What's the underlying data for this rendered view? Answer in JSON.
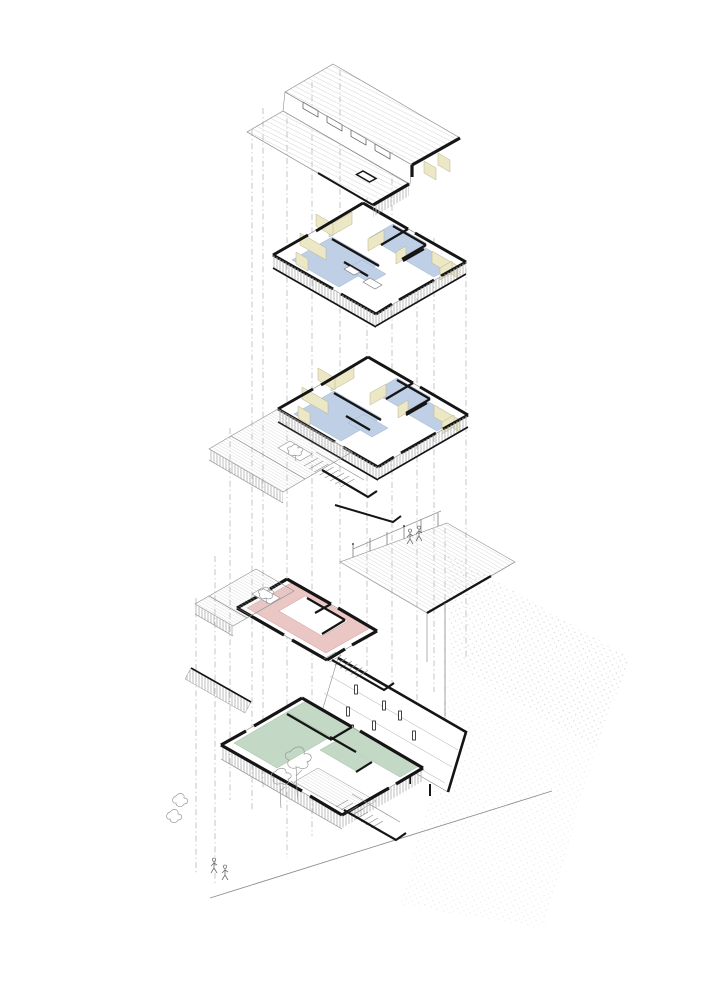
{
  "diagram": {
    "levels": [
      {
        "id": "roof"
      },
      {
        "id": "upper-floor"
      },
      {
        "id": "main-floor"
      },
      {
        "id": "ground-floor"
      },
      {
        "id": "basement-parking"
      }
    ]
  },
  "colors": {
    "paper": "#ffffff",
    "ink": "#151515",
    "line": "#8f8f8f",
    "line_light": "#c4c4c4",
    "hatch": "#c3c3c3",
    "stipple_dot": "#cdcdcd",
    "wall_yellow": "#ece8c6",
    "wall_yellow_edge": "#b8b28a",
    "floor_blue": "#bfd0e6",
    "floor_blue_edge": "#9eb3d2",
    "wall_pink": "#eac6c4",
    "wall_pink_edge": "#cf9d9b",
    "wall_green": "#c3d8c5",
    "wall_green_edge": "#9dbda0",
    "stripe": "#b5b5b5",
    "sketch": "#9a9a9a"
  }
}
